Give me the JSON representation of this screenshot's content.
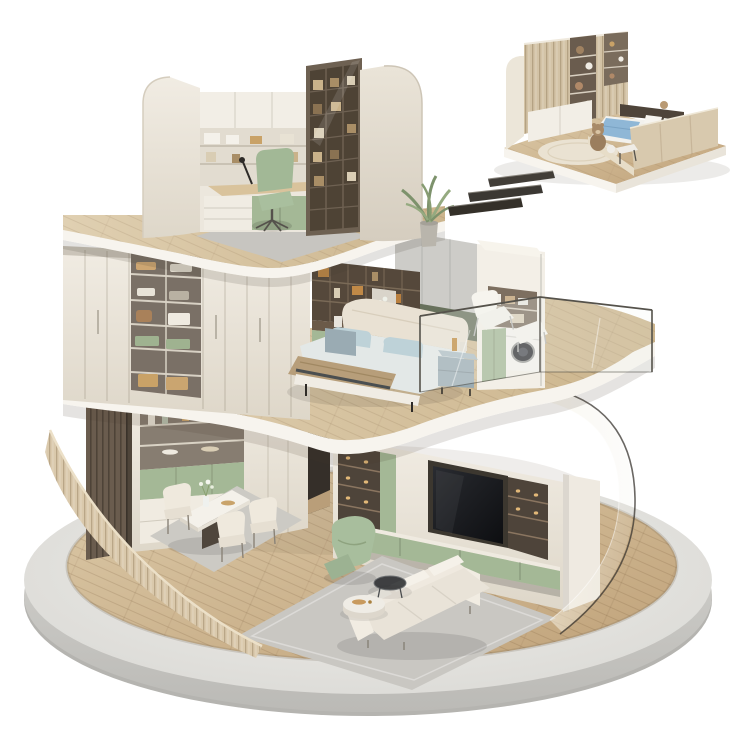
{
  "meta": {
    "title": "3D isometric cutaway render of a three-story round apartment on a circular platform, with a detached kids-bedroom vignette and motion dashes",
    "render_style": "product-style furniture showroom 3D render",
    "background": "#ffffff",
    "text_content": "none - image contains no visible text"
  },
  "scene": {
    "main_model": {
      "label": "three-story circular cutaway home",
      "platform": {
        "shape": "circular concrete disc",
        "floor": "light oak plank flooring",
        "front_wall": "curved cream louvered wall",
        "right_enclosure": "curved glass facade"
      },
      "floors": [
        {
          "name": "top floor study",
          "items": [
            "curved cream walls",
            "white wall shelving with storage boxes",
            "desk with laptop and black lamp",
            "sage green swivel chair",
            "bronze glass-door bookcase",
            "gray rug",
            "potted plant"
          ]
        },
        {
          "name": "middle floor bedroom",
          "items": [
            "walk-in wardrobe with open shelves of folded clothes",
            "white wardrobe doors",
            "dark wood display shelving with orange boxes",
            "vanity desk with orange chair",
            "upholstered bed with beige throw and blue pillows",
            "gray fabric headboard wall",
            "two blue-gray nightstands",
            "laundry niche with washing machine",
            "sage green cabinet doors",
            "glass-railed balcony",
            "white lounge chair and ottoman"
          ]
        },
        {
          "name": "ground floor living and dining",
          "items": [
            "dark wood slat panel",
            "display cabinet with vases",
            "sage green sideboard",
            "white marble dining table",
            "three cream dining chairs",
            "TV media wall with illuminated shelves",
            "large flat TV",
            "sage green base cabinets",
            "green recliner armchair",
            "white three-seat sofa",
            "round marble coffee table",
            "round dark glass side table",
            "two gray area rugs"
          ]
        }
      ]
    },
    "inset_model": {
      "label": "kids bedroom vignette",
      "items": [
        "striped wood wardrobe with teddy-bear display shelves",
        "platform bed with tall wood side rail",
        "blue blanket and pillows",
        "plush teddy bears",
        "round cream rug",
        "wooden base slab"
      ]
    },
    "motion_dashes": {
      "count": 3,
      "description": "dark diagonal speed dashes between vignette and main model"
    }
  },
  "palette": {
    "cream": "#ece7dd",
    "creamDark": "#d9d2c4",
    "fascia": "#f7f4ee",
    "wood": "#d5c1a0",
    "woodDark": "#b3946c",
    "green": "#a4b896",
    "greenDark": "#8ca07e",
    "bronze": "#55483b",
    "darkWood": "#4a4038",
    "concrete": "#cdccc8",
    "rug": "#c9c7c2",
    "tv": "#15171b",
    "blue": "#bed2d8",
    "tan": "#b79e7a",
    "orange": "#c8934f",
    "glassEdge": "#46433d",
    "platformTop": "#e9e8e4",
    "platformSide": "#c9c8c4",
    "nightstand": "#9aabb3",
    "teddy": "#a08261",
    "insetBlue": "#8fb7d6"
  }
}
